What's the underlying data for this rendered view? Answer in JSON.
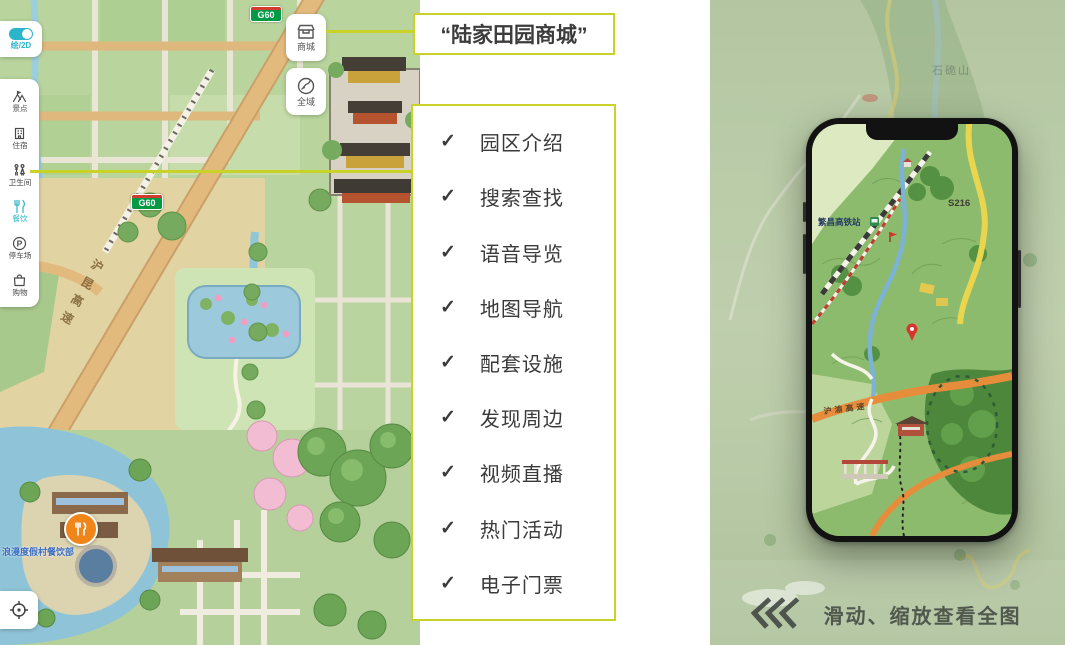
{
  "colors": {
    "accent_border": "#c9d327",
    "teal_accent": "#2ab5c8",
    "marker_orange": "#f08519",
    "badge_green": "#009a44",
    "badge_yellow": "#fdd12e",
    "text_dark": "#3c3c3c"
  },
  "left_map": {
    "view_toggle": {
      "label": "绘/2D"
    },
    "sidebar": {
      "items": [
        {
          "id": "scenic",
          "label": "景点",
          "icon": "landmark-icon"
        },
        {
          "id": "lodging",
          "label": "住宿",
          "icon": "hotel-icon"
        },
        {
          "id": "restroom",
          "label": "卫生间",
          "icon": "restroom-icon"
        },
        {
          "id": "dining",
          "label": "餐饮",
          "icon": "utensils-icon",
          "active": true
        },
        {
          "id": "parking",
          "label": "停车场",
          "icon": "parking-icon"
        },
        {
          "id": "shopping",
          "label": "购物",
          "icon": "shopping-bag-icon"
        }
      ]
    },
    "parking_glyph": "P",
    "corner_buttons": [
      {
        "id": "mall",
        "label": "商城",
        "icon": "shop-icon"
      },
      {
        "id": "global",
        "label": "全域",
        "icon": "compass-icon"
      }
    ],
    "road_badges": {
      "g60": "G60",
      "s324": "S324"
    },
    "expressway_name": "沪昆高速",
    "dining_poi_label": "浪漫度假村餐饮部"
  },
  "callout": {
    "title": "“陆家田园商城”"
  },
  "features": {
    "check_glyph": "✓",
    "items": [
      "园区介绍",
      "搜索查找",
      "语音导览",
      "地图导航",
      "配套设施",
      "发现周边",
      "视频直播",
      "热门活动",
      "电子门票"
    ]
  },
  "phone_map": {
    "station_label": "繁昌高铁站",
    "road_badge": "S216",
    "expressway_name": "沪渝高速"
  },
  "background_map": {
    "mountain_label": "石硊山"
  },
  "footer_hint": {
    "text": "滑动、缩放查看全图"
  }
}
